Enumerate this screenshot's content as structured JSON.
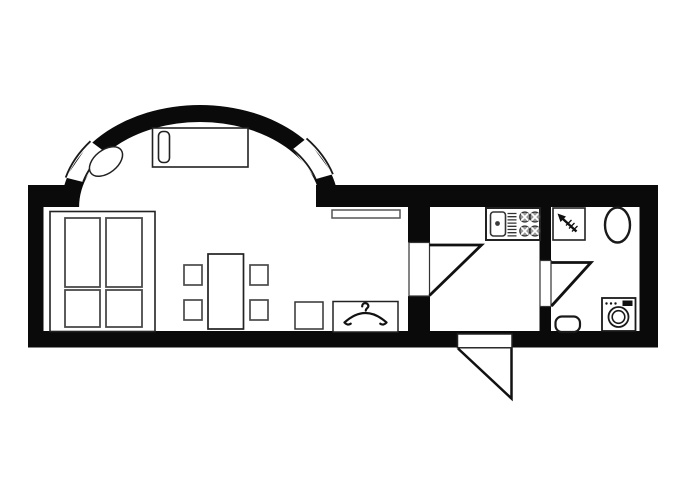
{
  "meta": {
    "description": "Black-and-white studio apartment floor plan: living room with elliptical bay (two bay windows), kitchen, bathroom, entry door",
    "canvas_width": 700,
    "canvas_height": 500
  },
  "colors": {
    "background": "#ffffff",
    "wall": "#0a0a0a",
    "outline_dark": "#1a1a1a",
    "outline_mid": "#333333",
    "outline_light": "#4a4a4a",
    "burner_fill": "#9a9a9a",
    "display_fill": "#111111"
  },
  "plan": {
    "viewbox": "0 0 700 500",
    "elements": [
      {
        "name": "bay-wall-ring",
        "el": "path",
        "attrs": {
          "d": "M61.1,207 A138.9,102 0 1 1 338.9,207 L320.9,207 A120.9,85 0 1 0 79.1,207 Z",
          "fill": "#0a0a0a"
        }
      },
      {
        "name": "bay-window-left-glass",
        "el": "polygon",
        "attrs": {
          "points": "65.7,177.6 90.5,141.2 104.7,151.7 83.1,182.0",
          "fill": "#ffffff"
        }
      },
      {
        "name": "bay-window-left-frame",
        "el": "path",
        "attrs": {
          "d": "M65.7,177.6 A139,102 0 0 1 90.5,141.2 M83.1,182 A121,85 0 0 1 104.7,151.7",
          "fill": "none",
          "stroke": "#1a1a1a",
          "stroke-width": "1.8"
        }
      },
      {
        "name": "bay-window-right-glass",
        "el": "polygon",
        "attrs": {
          "points": "306.5,138.4 332.9,174.2 315.7,179.1 292.7,149.4",
          "fill": "#ffffff"
        }
      },
      {
        "name": "bay-window-right-frame",
        "el": "path",
        "attrs": {
          "d": "M306.5,138.4 A139,102 0 0 1 332.9,174.2 M292.7,149.4 A121,85 0 0 1 315.7,179.1",
          "fill": "none",
          "stroke": "#1a1a1a",
          "stroke-width": "1.8"
        }
      },
      {
        "name": "wall-left",
        "el": "rect",
        "attrs": {
          "x": "28",
          "y": "185",
          "width": "15.5",
          "height": "162.5",
          "fill": "#0a0a0a"
        }
      },
      {
        "name": "wall-top-left",
        "el": "rect",
        "attrs": {
          "x": "28",
          "y": "185",
          "width": "50",
          "height": "22",
          "fill": "#0a0a0a"
        }
      },
      {
        "name": "wall-top-right",
        "el": "rect",
        "attrs": {
          "x": "316",
          "y": "185",
          "width": "342",
          "height": "22",
          "fill": "#0a0a0a"
        }
      },
      {
        "name": "wall-right",
        "el": "rect",
        "attrs": {
          "x": "639.5",
          "y": "185",
          "width": "18.5",
          "height": "162.5",
          "fill": "#0a0a0a"
        }
      },
      {
        "name": "wall-bottom",
        "el": "rect",
        "attrs": {
          "x": "28",
          "y": "331",
          "width": "630",
          "height": "16.5",
          "fill": "#0a0a0a"
        }
      },
      {
        "name": "wall-kitchen-partition-upper",
        "el": "rect",
        "attrs": {
          "x": "408",
          "y": "205",
          "width": "22",
          "height": "37.5",
          "fill": "#0a0a0a"
        }
      },
      {
        "name": "wall-kitchen-partition-lower",
        "el": "rect",
        "attrs": {
          "x": "408",
          "y": "296",
          "width": "22",
          "height": "36",
          "fill": "#0a0a0a"
        }
      },
      {
        "name": "wall-bath-partition-upper",
        "el": "rect",
        "attrs": {
          "x": "539.5",
          "y": "205",
          "width": "11.5",
          "height": "56",
          "fill": "#0a0a0a"
        }
      },
      {
        "name": "wall-bath-partition-lower",
        "el": "rect",
        "attrs": {
          "x": "539.5",
          "y": "306.5",
          "width": "11.5",
          "height": "25",
          "fill": "#0a0a0a"
        }
      },
      {
        "name": "entry-threshold",
        "el": "rect",
        "attrs": {
          "x": "457.5",
          "y": "334",
          "width": "54.5",
          "height": "13.8",
          "fill": "#ffffff",
          "stroke": "#222222",
          "stroke-width": "1.5"
        }
      },
      {
        "name": "entry-door-leaf",
        "el": "path",
        "attrs": {
          "d": "M458,348.5 L511.5,398.5 L511.5,348.5",
          "fill": "#ffffff",
          "stroke": "#111111",
          "stroke-width": "2.5"
        }
      },
      {
        "name": "kitchen-door-panel",
        "el": "rect",
        "attrs": {
          "x": "409",
          "y": "242.5",
          "width": "20.5",
          "height": "53.5",
          "fill": "#ffffff",
          "stroke": "#333333",
          "stroke-width": "1.2"
        }
      },
      {
        "name": "kitchen-door-leaf",
        "el": "path",
        "attrs": {
          "d": "M429.5,245 H481.5 L429.5,295.5",
          "fill": "none",
          "stroke": "#111111",
          "stroke-width": "2.8"
        }
      },
      {
        "name": "bath-door-panel",
        "el": "rect",
        "attrs": {
          "x": "540",
          "y": "260.5",
          "width": "11",
          "height": "46",
          "fill": "#ffffff",
          "stroke": "#333333",
          "stroke-width": "1.2"
        }
      },
      {
        "name": "bath-door-leaf",
        "el": "path",
        "attrs": {
          "d": "M551.5,262.5 H591 L551.5,306",
          "fill": "none",
          "stroke": "#111111",
          "stroke-width": "2.8"
        }
      },
      {
        "name": "bay-sofa",
        "el": "rect",
        "attrs": {
          "x": "152.5",
          "y": "128",
          "width": "95.5",
          "height": "39",
          "fill": "#ffffff",
          "stroke": "#222222",
          "stroke-width": "1.6"
        }
      },
      {
        "name": "bay-sofa-cushion",
        "el": "rect",
        "attrs": {
          "x": "158.5",
          "y": "131.5",
          "width": "11",
          "height": "31",
          "rx": "4.5",
          "fill": "#ffffff",
          "stroke": "#222222",
          "stroke-width": "1.6"
        }
      },
      {
        "name": "bay-oval-table",
        "el": "ellipse",
        "attrs": {
          "cx": "106",
          "cy": "161.5",
          "rx": "19",
          "ry": "11.5",
          "fill": "#ffffff",
          "stroke": "#222222",
          "stroke-width": "1.5",
          "transform": "rotate(-38 106 161.5)"
        }
      },
      {
        "name": "wardrobe-outline",
        "el": "rect",
        "attrs": {
          "x": "50",
          "y": "211.5",
          "width": "105",
          "height": "120",
          "fill": "#ffffff",
          "stroke": "#222222",
          "stroke-width": "1.6"
        }
      },
      {
        "name": "wardrobe-panel-top-left",
        "el": "rect",
        "attrs": {
          "x": "65",
          "y": "218",
          "width": "35",
          "height": "69",
          "fill": "#ffffff",
          "stroke": "#4a4a4a",
          "stroke-width": "1.8"
        }
      },
      {
        "name": "wardrobe-panel-top-right",
        "el": "rect",
        "attrs": {
          "x": "106",
          "y": "218",
          "width": "36",
          "height": "69",
          "fill": "#ffffff",
          "stroke": "#4a4a4a",
          "stroke-width": "1.8"
        }
      },
      {
        "name": "wardrobe-panel-bottom-left",
        "el": "rect",
        "attrs": {
          "x": "65",
          "y": "290",
          "width": "35",
          "height": "37",
          "fill": "#ffffff",
          "stroke": "#4a4a4a",
          "stroke-width": "1.8"
        }
      },
      {
        "name": "wardrobe-panel-bottom-right",
        "el": "rect",
        "attrs": {
          "x": "106",
          "y": "290",
          "width": "36",
          "height": "37",
          "fill": "#ffffff",
          "stroke": "#4a4a4a",
          "stroke-width": "1.8"
        }
      },
      {
        "name": "dining-table",
        "el": "rect",
        "attrs": {
          "x": "208",
          "y": "254",
          "width": "35.5",
          "height": "75",
          "fill": "#ffffff",
          "stroke": "#222222",
          "stroke-width": "1.7"
        }
      },
      {
        "name": "chair-top-left",
        "el": "rect",
        "attrs": {
          "x": "184",
          "y": "265",
          "width": "18",
          "height": "20",
          "fill": "#ffffff",
          "stroke": "#4a4a4a",
          "stroke-width": "1.7"
        }
      },
      {
        "name": "chair-bottom-left",
        "el": "rect",
        "attrs": {
          "x": "184",
          "y": "300",
          "width": "18",
          "height": "20",
          "fill": "#ffffff",
          "stroke": "#4a4a4a",
          "stroke-width": "1.7"
        }
      },
      {
        "name": "chair-top-right",
        "el": "rect",
        "attrs": {
          "x": "250",
          "y": "265",
          "width": "18",
          "height": "20",
          "fill": "#ffffff",
          "stroke": "#4a4a4a",
          "stroke-width": "1.7"
        }
      },
      {
        "name": "chair-bottom-right",
        "el": "rect",
        "attrs": {
          "x": "250",
          "y": "300",
          "width": "18",
          "height": "20",
          "fill": "#ffffff",
          "stroke": "#4a4a4a",
          "stroke-width": "1.7"
        }
      },
      {
        "name": "wall-shelf",
        "el": "rect",
        "attrs": {
          "x": "332",
          "y": "210",
          "width": "68",
          "height": "8",
          "fill": "#ffffff",
          "stroke": "#555555",
          "stroke-width": "1.5"
        }
      },
      {
        "name": "stool",
        "el": "rect",
        "attrs": {
          "x": "295",
          "y": "302",
          "width": "28",
          "height": "27",
          "fill": "#ffffff",
          "stroke": "#333333",
          "stroke-width": "1.5"
        }
      },
      {
        "name": "coat-closet",
        "el": "rect",
        "attrs": {
          "x": "333",
          "y": "301.5",
          "width": "65",
          "height": "30.5",
          "fill": "#ffffff",
          "stroke": "#222222",
          "stroke-width": "1.5"
        }
      },
      {
        "name": "coat-hanger-icon",
        "el": "path",
        "attrs": {
          "d": "M365.8,310.5 c0,-2.2 2.6,-2.4 2.6,-4.4 a3.1,3.1 0 1 0 -6.2,0.3 M344.5,322.5 Q365.5,303.5 386.5,322.5 M344.5,322.5 c1.5,2 4,2.6 6.2,1.2 M386.5,322.5 c-1.5,2 -4,2.6 -6.2,1.2",
          "fill": "none",
          "stroke": "#111111",
          "stroke-width": "2.2",
          "stroke-linecap": "round"
        }
      },
      {
        "name": "kitchen-unit",
        "el": "rect",
        "attrs": {
          "x": "486",
          "y": "208",
          "width": "54",
          "height": "32",
          "fill": "#ffffff",
          "stroke": "#222222",
          "stroke-width": "2"
        }
      },
      {
        "name": "sink-bowl",
        "el": "rect",
        "attrs": {
          "x": "490.5",
          "y": "212",
          "width": "15",
          "height": "24",
          "rx": "3",
          "fill": "#ffffff",
          "stroke": "#333333",
          "stroke-width": "1.6"
        }
      },
      {
        "name": "sink-tap",
        "el": "circle",
        "attrs": {
          "cx": "497.5",
          "cy": "223.5",
          "r": "2.4",
          "fill": "#3a3a3a"
        }
      },
      {
        "name": "sink-drainer",
        "el": "path",
        "attrs": {
          "d": "M507.5,213.5 h9 M507.5,216.7 h9 M507.5,219.9 h9 M507.5,223.1 h9 M507.5,226.3 h9 M507.5,229.5 h9 M507.5,232.7 h9 M507.5,235.9 h9",
          "fill": "none",
          "stroke": "#333333",
          "stroke-width": "1.3"
        }
      },
      {
        "name": "stove-burner-1",
        "el": "circle",
        "attrs": {
          "cx": "524.8",
          "cy": "217",
          "r": "5",
          "fill": "#9a9a9a",
          "stroke": "#333333",
          "stroke-width": "1.2"
        }
      },
      {
        "name": "stove-burner-1-divider",
        "el": "path",
        "attrs": {
          "d": "M521.2,213.4 L528.4,220.6 M521.2,220.6 L528.4,213.4",
          "stroke": "#ffffff",
          "stroke-width": "1.7",
          "fill": "none"
        }
      },
      {
        "name": "stove-burner-2",
        "el": "circle",
        "attrs": {
          "cx": "535",
          "cy": "217",
          "r": "5",
          "fill": "#9a9a9a",
          "stroke": "#333333",
          "stroke-width": "1.2"
        }
      },
      {
        "name": "stove-burner-2-divider",
        "el": "path",
        "attrs": {
          "d": "M531.4,213.4 L538.6,220.6 M531.4,220.6 L538.6,213.4",
          "stroke": "#ffffff",
          "stroke-width": "1.7",
          "fill": "none"
        }
      },
      {
        "name": "stove-burner-3",
        "el": "circle",
        "attrs": {
          "cx": "524.8",
          "cy": "231",
          "r": "5",
          "fill": "#9a9a9a",
          "stroke": "#333333",
          "stroke-width": "1.2"
        }
      },
      {
        "name": "stove-burner-3-divider",
        "el": "path",
        "attrs": {
          "d": "M521.2,227.4 L528.4,234.6 M521.2,234.6 L528.4,227.4",
          "stroke": "#ffffff",
          "stroke-width": "1.7",
          "fill": "none"
        }
      },
      {
        "name": "stove-burner-4",
        "el": "circle",
        "attrs": {
          "cx": "535",
          "cy": "231",
          "r": "5",
          "fill": "#9a9a9a",
          "stroke": "#333333",
          "stroke-width": "1.2"
        }
      },
      {
        "name": "stove-burner-4-divider",
        "el": "path",
        "attrs": {
          "d": "M531.4,227.4 L538.6,234.6 M531.4,234.6 L538.6,227.4",
          "stroke": "#ffffff",
          "stroke-width": "1.7",
          "fill": "none"
        }
      },
      {
        "name": "shower-tray",
        "el": "rect",
        "attrs": {
          "x": "553",
          "y": "208",
          "width": "32",
          "height": "32",
          "fill": "#ffffff",
          "stroke": "#222222",
          "stroke-width": "1.6"
        }
      },
      {
        "name": "shower-head-icon",
        "el": "path",
        "attrs": {
          "d": "M557.5,213.5 l8.5,3 -5.5,5.5 z",
          "fill": "#111111"
        }
      },
      {
        "name": "shower-hose-icon",
        "el": "path",
        "attrs": {
          "d": "M563,219 l13.5,12.5",
          "fill": "none",
          "stroke": "#111111",
          "stroke-width": "2.4"
        }
      },
      {
        "name": "shower-hatch-icon",
        "el": "path",
        "attrs": {
          "d": "M566,225.5 l5.5,-5.5 M569,228.5 l5.5,-5.5 M572,231.5 l5.5,-5.5",
          "fill": "none",
          "stroke": "#111111",
          "stroke-width": "1.3"
        }
      },
      {
        "name": "toilet",
        "el": "ellipse",
        "attrs": {
          "cx": "617.5",
          "cy": "225",
          "rx": "12.5",
          "ry": "17.5",
          "fill": "#ffffff",
          "stroke": "#1a1a1a",
          "stroke-width": "2.4"
        }
      },
      {
        "name": "basin",
        "el": "rect",
        "attrs": {
          "x": "555.5",
          "y": "316.5",
          "width": "24.5",
          "height": "15.5",
          "rx": "6.5",
          "fill": "#ffffff",
          "stroke": "#1a1a1a",
          "stroke-width": "2.2"
        }
      },
      {
        "name": "washer-body",
        "el": "rect",
        "attrs": {
          "x": "602",
          "y": "298",
          "width": "33.5",
          "height": "33",
          "fill": "#ffffff",
          "stroke": "#1a1a1a",
          "stroke-width": "1.8"
        }
      },
      {
        "name": "washer-drum-outer",
        "el": "circle",
        "attrs": {
          "cx": "618.5",
          "cy": "317",
          "r": "10",
          "fill": "#ffffff",
          "stroke": "#1a1a1a",
          "stroke-width": "1.8"
        }
      },
      {
        "name": "washer-drum-inner",
        "el": "circle",
        "attrs": {
          "cx": "618.5",
          "cy": "317",
          "r": "6.3",
          "fill": "#ffffff",
          "stroke": "#1a1a1a",
          "stroke-width": "1.6"
        }
      },
      {
        "name": "washer-buttons",
        "el": "path",
        "attrs": {
          "d": "M606.5,303.5 l0.01,0 M611,303.5 l0.01,0 M615.5,303.5 l0.01,0",
          "fill": "none",
          "stroke": "#111111",
          "stroke-width": "2.4",
          "stroke-linecap": "round"
        }
      },
      {
        "name": "washer-display",
        "el": "rect",
        "attrs": {
          "x": "622.5",
          "y": "300.5",
          "width": "10",
          "height": "5.5",
          "fill": "#111111"
        }
      }
    ]
  }
}
